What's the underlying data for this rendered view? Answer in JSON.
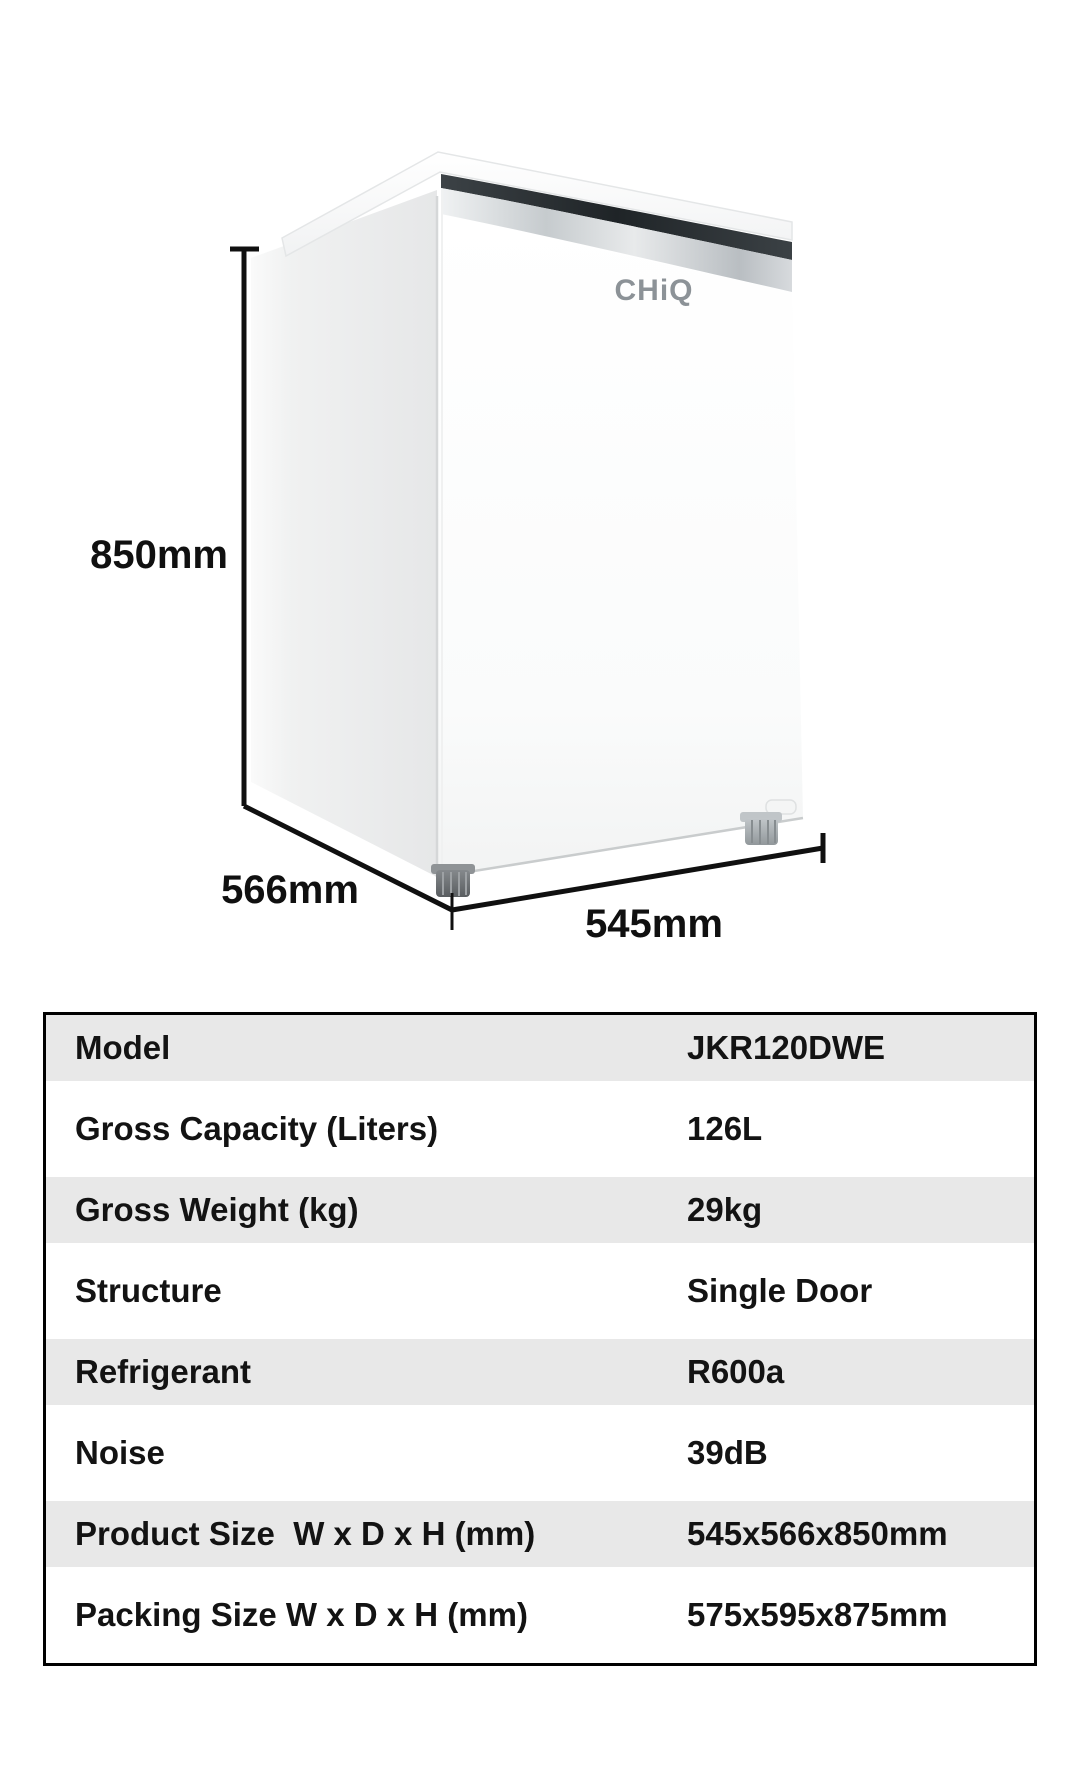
{
  "product": {
    "brand_logo": "CHiQ",
    "dimension_labels": {
      "height": "850mm",
      "depth": "566mm",
      "width": "545mm"
    }
  },
  "spec_table": {
    "rows": [
      {
        "label": "Model",
        "value": "JKR120DWE"
      },
      {
        "label": "Gross Capacity (Liters)",
        "value": "126L"
      },
      {
        "label": "Gross Weight (kg)",
        "value": "29kg"
      },
      {
        "label": "Structure",
        "value": "Single Door"
      },
      {
        "label": "Refrigerant",
        "value": "R600a"
      },
      {
        "label": "Noise",
        "value": "39dB"
      },
      {
        "label": "Product Size  W x D x H (mm)",
        "value": "545x566x850mm"
      },
      {
        "label": "Packing Size W x D x H (mm)",
        "value": "575x595x875mm"
      }
    ]
  },
  "colors": {
    "row_alt_background": "#e8e8e8",
    "table_border": "#000000",
    "dimension_line": "#101010",
    "logo_gray": "#8c9297"
  }
}
